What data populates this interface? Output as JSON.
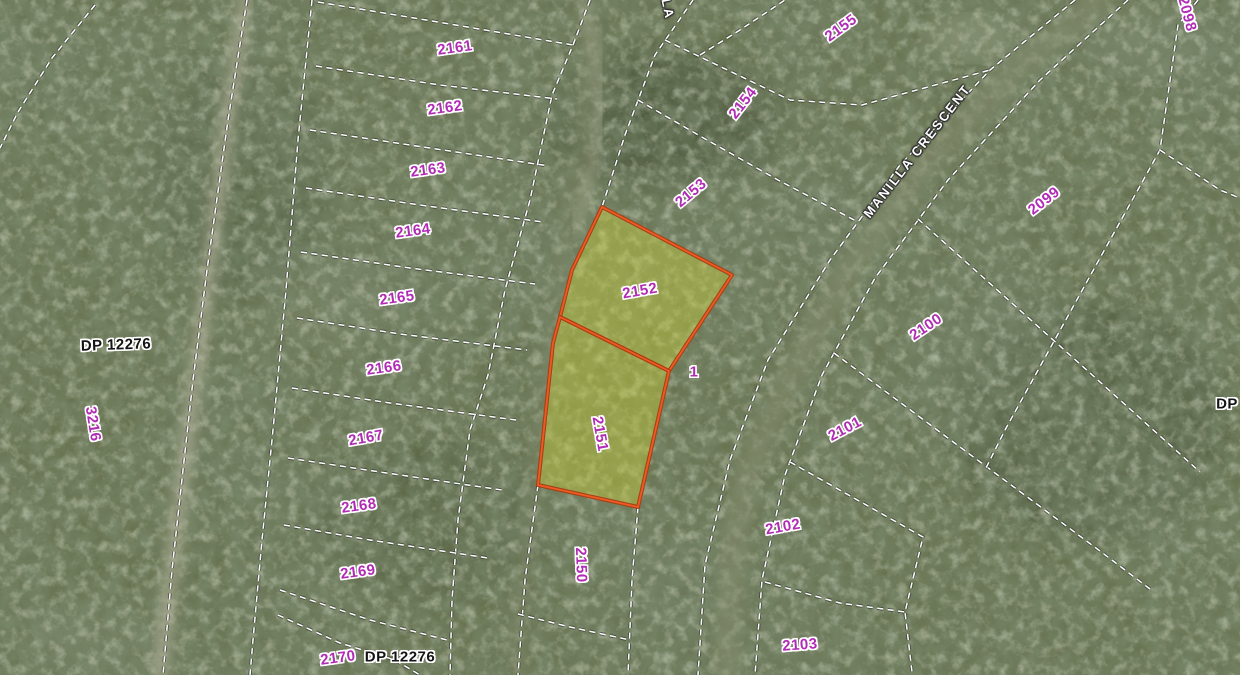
{
  "map": {
    "kind": "cadastral-parcel-overlay-on-aerial-imagery",
    "colors": {
      "parcel_label": "#b12cb5",
      "plan_label": "#141414",
      "street_label": "#ffffff",
      "boundary_dash": "#ffffff",
      "boundary_casing": "rgba(35,35,35,0.55)",
      "highlight_stroke": "#ef5a22",
      "highlight_stroke_outer": "#a83c10",
      "highlight_fill": "rgba(210,218,50,0.42)",
      "aerial_base": "#67724f"
    },
    "highlighted_parcels": [
      "2152",
      "2151"
    ],
    "labels": [
      {
        "text": "2161",
        "x": 455,
        "y": 48,
        "rot": -8,
        "kind": "parcel"
      },
      {
        "text": "2162",
        "x": 445,
        "y": 108,
        "rot": -8,
        "kind": "parcel"
      },
      {
        "text": "2163",
        "x": 428,
        "y": 170,
        "rot": -8,
        "kind": "parcel"
      },
      {
        "text": "2164",
        "x": 413,
        "y": 231,
        "rot": -8,
        "kind": "parcel"
      },
      {
        "text": "2165",
        "x": 397,
        "y": 298,
        "rot": -8,
        "kind": "parcel"
      },
      {
        "text": "2166",
        "x": 384,
        "y": 368,
        "rot": -8,
        "kind": "parcel"
      },
      {
        "text": "2167",
        "x": 366,
        "y": 438,
        "rot": -10,
        "kind": "parcel"
      },
      {
        "text": "2168",
        "x": 359,
        "y": 506,
        "rot": -8,
        "kind": "parcel"
      },
      {
        "text": "2169",
        "x": 358,
        "y": 572,
        "rot": -8,
        "kind": "parcel"
      },
      {
        "text": "2170",
        "x": 338,
        "y": 658,
        "rot": -8,
        "kind": "parcel"
      },
      {
        "text": "DP 12276",
        "x": 400,
        "y": 657,
        "rot": 0,
        "kind": "plan"
      },
      {
        "text": "DP 12276",
        "x": 116,
        "y": 345,
        "rot": -2,
        "kind": "plan"
      },
      {
        "text": "3216",
        "x": 93,
        "y": 424,
        "rot": 81,
        "kind": "parcel"
      },
      {
        "text": "2150",
        "x": 581,
        "y": 565,
        "rot": 88,
        "kind": "parcel"
      },
      {
        "text": "2151",
        "x": 600,
        "y": 434,
        "rot": 80,
        "kind": "parcel"
      },
      {
        "text": "2152",
        "x": 640,
        "y": 291,
        "rot": -10,
        "kind": "parcel"
      },
      {
        "text": "1",
        "x": 694,
        "y": 372,
        "rot": 0,
        "kind": "parcel"
      },
      {
        "text": "2153",
        "x": 691,
        "y": 193,
        "rot": -40,
        "kind": "parcel"
      },
      {
        "text": "2154",
        "x": 743,
        "y": 103,
        "rot": -52,
        "kind": "parcel"
      },
      {
        "text": "2155",
        "x": 841,
        "y": 28,
        "rot": -36,
        "kind": "parcel"
      },
      {
        "text": "2098",
        "x": 1187,
        "y": 14,
        "rot": 75,
        "kind": "parcel"
      },
      {
        "text": "2099",
        "x": 1044,
        "y": 201,
        "rot": -38,
        "kind": "parcel"
      },
      {
        "text": "2100",
        "x": 926,
        "y": 327,
        "rot": -34,
        "kind": "parcel"
      },
      {
        "text": "2101",
        "x": 845,
        "y": 429,
        "rot": -28,
        "kind": "parcel"
      },
      {
        "text": "2102",
        "x": 783,
        "y": 527,
        "rot": -10,
        "kind": "parcel"
      },
      {
        "text": "2103",
        "x": 800,
        "y": 645,
        "rot": -4,
        "kind": "parcel"
      },
      {
        "text": "DP",
        "x": 1227,
        "y": 404,
        "rot": 0,
        "kind": "plan"
      },
      {
        "text": "DP 12276",
        "x": 806,
        "y": -7,
        "rot": 0,
        "kind": "plan"
      },
      {
        "text": "MANILLA CRESCENT",
        "x": 917,
        "y": 151,
        "rot": -52,
        "kind": "street"
      },
      {
        "text": "LA",
        "x": 668,
        "y": 9,
        "rot": 78,
        "kind": "street"
      }
    ],
    "highlight_polygons": [
      {
        "id": "2152",
        "points": [
          [
            602,
            207
          ],
          [
            732,
            275
          ],
          [
            669,
            371
          ],
          [
            560,
            317
          ],
          [
            572,
            270
          ]
        ]
      },
      {
        "id": "2151",
        "points": [
          [
            560,
            317
          ],
          [
            669,
            371
          ],
          [
            638,
            507
          ],
          [
            538,
            485
          ],
          [
            553,
            343
          ]
        ]
      }
    ],
    "boundaries": [
      {
        "points": [
          [
            95,
            5
          ],
          [
            52,
            58
          ],
          [
            18,
            112
          ],
          [
            0,
            148
          ]
        ]
      },
      {
        "points": [
          [
            247,
            0
          ],
          [
            228,
            120
          ],
          [
            207,
            270
          ],
          [
            193,
            380
          ],
          [
            183,
            470
          ],
          [
            172,
            570
          ],
          [
            163,
            675
          ]
        ]
      },
      {
        "points": [
          [
            312,
            0
          ],
          [
            298,
            140
          ],
          [
            286,
            290
          ],
          [
            273,
            430
          ],
          [
            262,
            540
          ],
          [
            253,
            640
          ],
          [
            250,
            675
          ]
        ]
      },
      {
        "points": [
          [
            318,
            2
          ],
          [
            450,
            24
          ],
          [
            573,
            45
          ]
        ]
      },
      {
        "points": [
          [
            590,
            0
          ],
          [
            573,
            45
          ],
          [
            552,
            95
          ],
          [
            530,
            200
          ],
          [
            505,
            290
          ],
          [
            488,
            375
          ],
          [
            470,
            430
          ],
          [
            458,
            520
          ],
          [
            452,
            600
          ],
          [
            450,
            675
          ]
        ]
      },
      {
        "points": [
          [
            316,
            66
          ],
          [
            440,
            85
          ],
          [
            557,
            99
          ]
        ]
      },
      {
        "points": [
          [
            310,
            130
          ],
          [
            430,
            148
          ],
          [
            549,
            166
          ]
        ]
      },
      {
        "points": [
          [
            306,
            188
          ],
          [
            420,
            205
          ],
          [
            543,
            222
          ]
        ]
      },
      {
        "points": [
          [
            301,
            252
          ],
          [
            410,
            268
          ],
          [
            535,
            284
          ]
        ]
      },
      {
        "points": [
          [
            297,
            318
          ],
          [
            400,
            334
          ],
          [
            527,
            350
          ]
        ]
      },
      {
        "points": [
          [
            292,
            388
          ],
          [
            390,
            403
          ],
          [
            516,
            420
          ]
        ]
      },
      {
        "points": [
          [
            288,
            458
          ],
          [
            380,
            472
          ],
          [
            502,
            490
          ]
        ]
      },
      {
        "points": [
          [
            284,
            525
          ],
          [
            370,
            540
          ],
          [
            488,
            558
          ]
        ]
      },
      {
        "points": [
          [
            280,
            590
          ],
          [
            370,
            620
          ],
          [
            447,
            640
          ]
        ]
      },
      {
        "points": [
          [
            278,
            615
          ],
          [
            340,
            643
          ],
          [
            395,
            660
          ],
          [
            420,
            675
          ]
        ]
      },
      {
        "points": [
          [
            693,
            0
          ],
          [
            655,
            55
          ],
          [
            625,
            135
          ],
          [
            602,
            207
          ]
        ]
      },
      {
        "points": [
          [
            538,
            485
          ],
          [
            525,
            580
          ],
          [
            518,
            675
          ]
        ]
      },
      {
        "points": [
          [
            638,
            507
          ],
          [
            632,
            580
          ],
          [
            628,
            675
          ]
        ]
      },
      {
        "points": [
          [
            518,
            614
          ],
          [
            570,
            627
          ],
          [
            630,
            640
          ]
        ]
      },
      {
        "points": [
          [
            1075,
            0
          ],
          [
            990,
            70
          ],
          [
            900,
            165
          ],
          [
            830,
            260
          ],
          [
            768,
            360
          ],
          [
            730,
            460
          ],
          [
            705,
            565
          ],
          [
            698,
            675
          ]
        ]
      },
      {
        "points": [
          [
            1128,
            0
          ],
          [
            1040,
            80
          ],
          [
            948,
            180
          ],
          [
            875,
            278
          ],
          [
            822,
            375
          ],
          [
            785,
            475
          ],
          [
            762,
            580
          ],
          [
            755,
            675
          ]
        ]
      },
      {
        "points": [
          [
            638,
            100
          ],
          [
            707,
            140
          ],
          [
            778,
            180
          ],
          [
            858,
            222
          ]
        ]
      },
      {
        "points": [
          [
            665,
            40
          ],
          [
            790,
            100
          ],
          [
            862,
            105
          ],
          [
            990,
            70
          ]
        ]
      },
      {
        "points": [
          [
            700,
            55
          ],
          [
            740,
            30
          ],
          [
            785,
            0
          ]
        ]
      },
      {
        "points": [
          [
            918,
            219
          ],
          [
            1070,
            355
          ],
          [
            1200,
            472
          ]
        ]
      },
      {
        "points": [
          [
            834,
            353
          ],
          [
            960,
            447
          ],
          [
            1100,
            551
          ],
          [
            1150,
            589
          ]
        ]
      },
      {
        "points": [
          [
            790,
            462
          ],
          [
            923,
            537
          ],
          [
            905,
            612
          ],
          [
            912,
            672
          ]
        ]
      },
      {
        "points": [
          [
            765,
            582
          ],
          [
            840,
            603
          ],
          [
            905,
            612
          ]
        ]
      },
      {
        "points": [
          [
            1198,
            0
          ],
          [
            1178,
            25
          ],
          [
            1160,
            150
          ],
          [
            1100,
            258
          ],
          [
            1053,
            343
          ],
          [
            1005,
            430
          ],
          [
            985,
            470
          ]
        ]
      },
      {
        "points": [
          [
            1160,
            150
          ],
          [
            1220,
            190
          ],
          [
            1240,
            198
          ]
        ]
      }
    ],
    "roads": [
      {
        "name": "dirt-track-west",
        "color": "#b3b29b",
        "width": 12,
        "opacity": 0.75,
        "points": [
          [
            245,
            0
          ],
          [
            225,
            140
          ],
          [
            205,
            300
          ],
          [
            192,
            400
          ],
          [
            180,
            500
          ],
          [
            168,
            600
          ],
          [
            160,
            675
          ]
        ]
      },
      {
        "name": "track-top-centre",
        "color": "#a9ac93",
        "width": 9,
        "opacity": 0.7,
        "points": [
          [
            583,
            0
          ],
          [
            596,
            60
          ],
          [
            600,
            120
          ],
          [
            588,
            185
          ],
          [
            575,
            230
          ]
        ]
      },
      {
        "name": "manilla-clearing",
        "color": "#848c6d",
        "width": 26,
        "opacity": 0.55,
        "points": [
          [
            1100,
            0
          ],
          [
            1010,
            75
          ],
          [
            920,
            170
          ],
          [
            850,
            270
          ],
          [
            795,
            370
          ],
          [
            748,
            470
          ],
          [
            732,
            560
          ],
          [
            726,
            675
          ]
        ]
      },
      {
        "name": "corridor-clearing",
        "color": "#7e8668",
        "width": 18,
        "opacity": 0.4,
        "points": [
          [
            595,
            30
          ],
          [
            570,
            200
          ],
          [
            545,
            400
          ],
          [
            525,
            560
          ],
          [
            515,
            675
          ]
        ]
      }
    ],
    "patches": [
      {
        "cx": 975,
        "cy": 38,
        "rx": 48,
        "ry": 22,
        "color": "#9aa083",
        "opacity": 0.8
      },
      {
        "cx": 1160,
        "cy": 45,
        "rx": 70,
        "ry": 35,
        "color": "#8d947a",
        "opacity": 0.5
      },
      {
        "cx": 660,
        "cy": 120,
        "rx": 120,
        "ry": 70,
        "color": "#3c4730",
        "opacity": 0.5
      },
      {
        "cx": 1090,
        "cy": 420,
        "rx": 140,
        "ry": 120,
        "color": "#46513a",
        "opacity": 0.45
      },
      {
        "cx": 240,
        "cy": 180,
        "rx": 90,
        "ry": 120,
        "color": "#49543c",
        "opacity": 0.4
      },
      {
        "cx": 430,
        "cy": 520,
        "rx": 120,
        "ry": 80,
        "color": "#515c42",
        "opacity": 0.4
      },
      {
        "cx": 330,
        "cy": 300,
        "rx": 70,
        "ry": 50,
        "color": "#8b9278",
        "opacity": 0.35
      },
      {
        "cx": 90,
        "cy": 640,
        "rx": 80,
        "ry": 40,
        "color": "#87907b",
        "opacity": 0.35
      },
      {
        "cx": 560,
        "cy": 90,
        "rx": 60,
        "ry": 50,
        "color": "#717c5c",
        "opacity": 0.4
      }
    ]
  }
}
